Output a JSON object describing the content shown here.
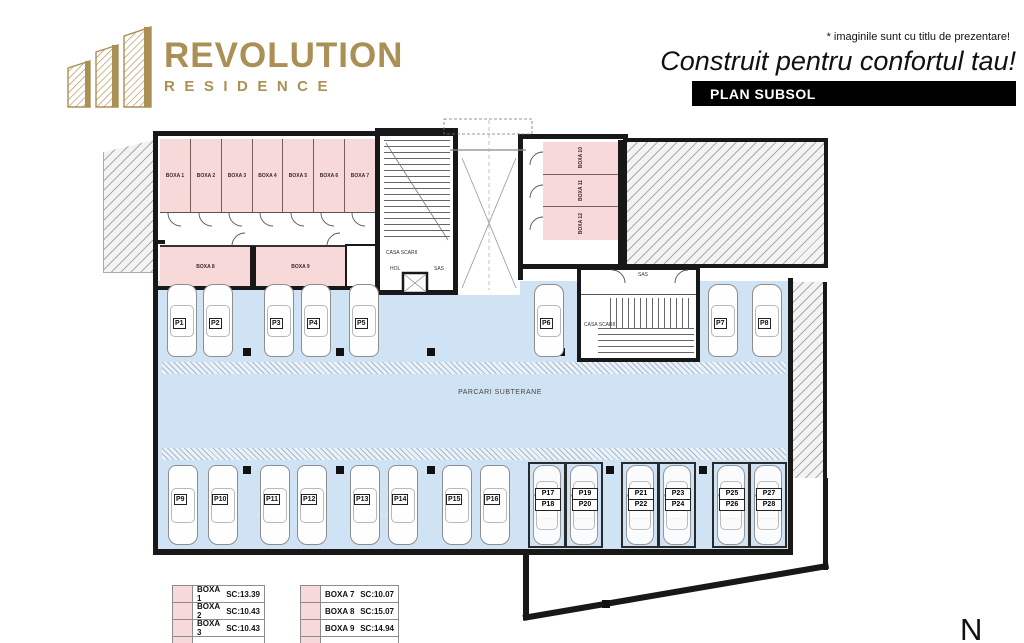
{
  "header": {
    "logo_line1": "REVOLUTION",
    "logo_line2": "RESIDENCE",
    "disclaimer": "* imaginile sunt cu titlu de prezentare!",
    "tagline": "Construit pentru confortul tau!",
    "plan_title": "PLAN SUBSOL"
  },
  "colors": {
    "gold": "#ab9055",
    "room_pink": "#f7d9d9",
    "parking_blue": "#cfe3f4",
    "wall_black": "#181818"
  },
  "plan": {
    "area_label": "PARCARI SUBTERANE",
    "north_label": "N",
    "rooms": {
      "boxa_row_top": [
        "BOXA 1",
        "BOXA 2",
        "BOXA 3",
        "BOXA 4",
        "BOXA 5",
        "BOXA 6",
        "BOXA 7"
      ],
      "boxa_mid": [
        "BOXA 8",
        "BOXA 9"
      ],
      "boxa_right": [
        "BOXA 10",
        "BOXA 11",
        "BOXA 12"
      ],
      "stair_left_label": "CASA SCARII",
      "stair_right_label": "CASA SCARII",
      "hol_label": "HOL",
      "sas_label": "SAS"
    },
    "parking": {
      "top_row": [
        "P1",
        "P2",
        "P3",
        "P4",
        "P5",
        "P6",
        "P7",
        "P8"
      ],
      "bottom_row": [
        "P9",
        "P10",
        "P11",
        "P12",
        "P13",
        "P14",
        "P15",
        "P16"
      ],
      "stacked": [
        {
          "top": "P17",
          "bottom": "P18"
        },
        {
          "top": "P19",
          "bottom": "P20"
        },
        {
          "top": "P21",
          "bottom": "P22"
        },
        {
          "top": "P23",
          "bottom": "P24"
        },
        {
          "top": "P25",
          "bottom": "P26"
        },
        {
          "top": "P27",
          "bottom": "P28"
        }
      ]
    }
  },
  "legend": {
    "left": [
      {
        "name": "BOXA 1",
        "sc": "SC:13.39"
      },
      {
        "name": "BOXA 2",
        "sc": "SC:10.43"
      },
      {
        "name": "BOXA 3",
        "sc": "SC:10.43"
      }
    ],
    "right": [
      {
        "name": "BOXA 7",
        "sc": "SC:10.07"
      },
      {
        "name": "BOXA 8",
        "sc": "SC:15.07"
      },
      {
        "name": "BOXA 9",
        "sc": "SC:14.94"
      }
    ]
  }
}
